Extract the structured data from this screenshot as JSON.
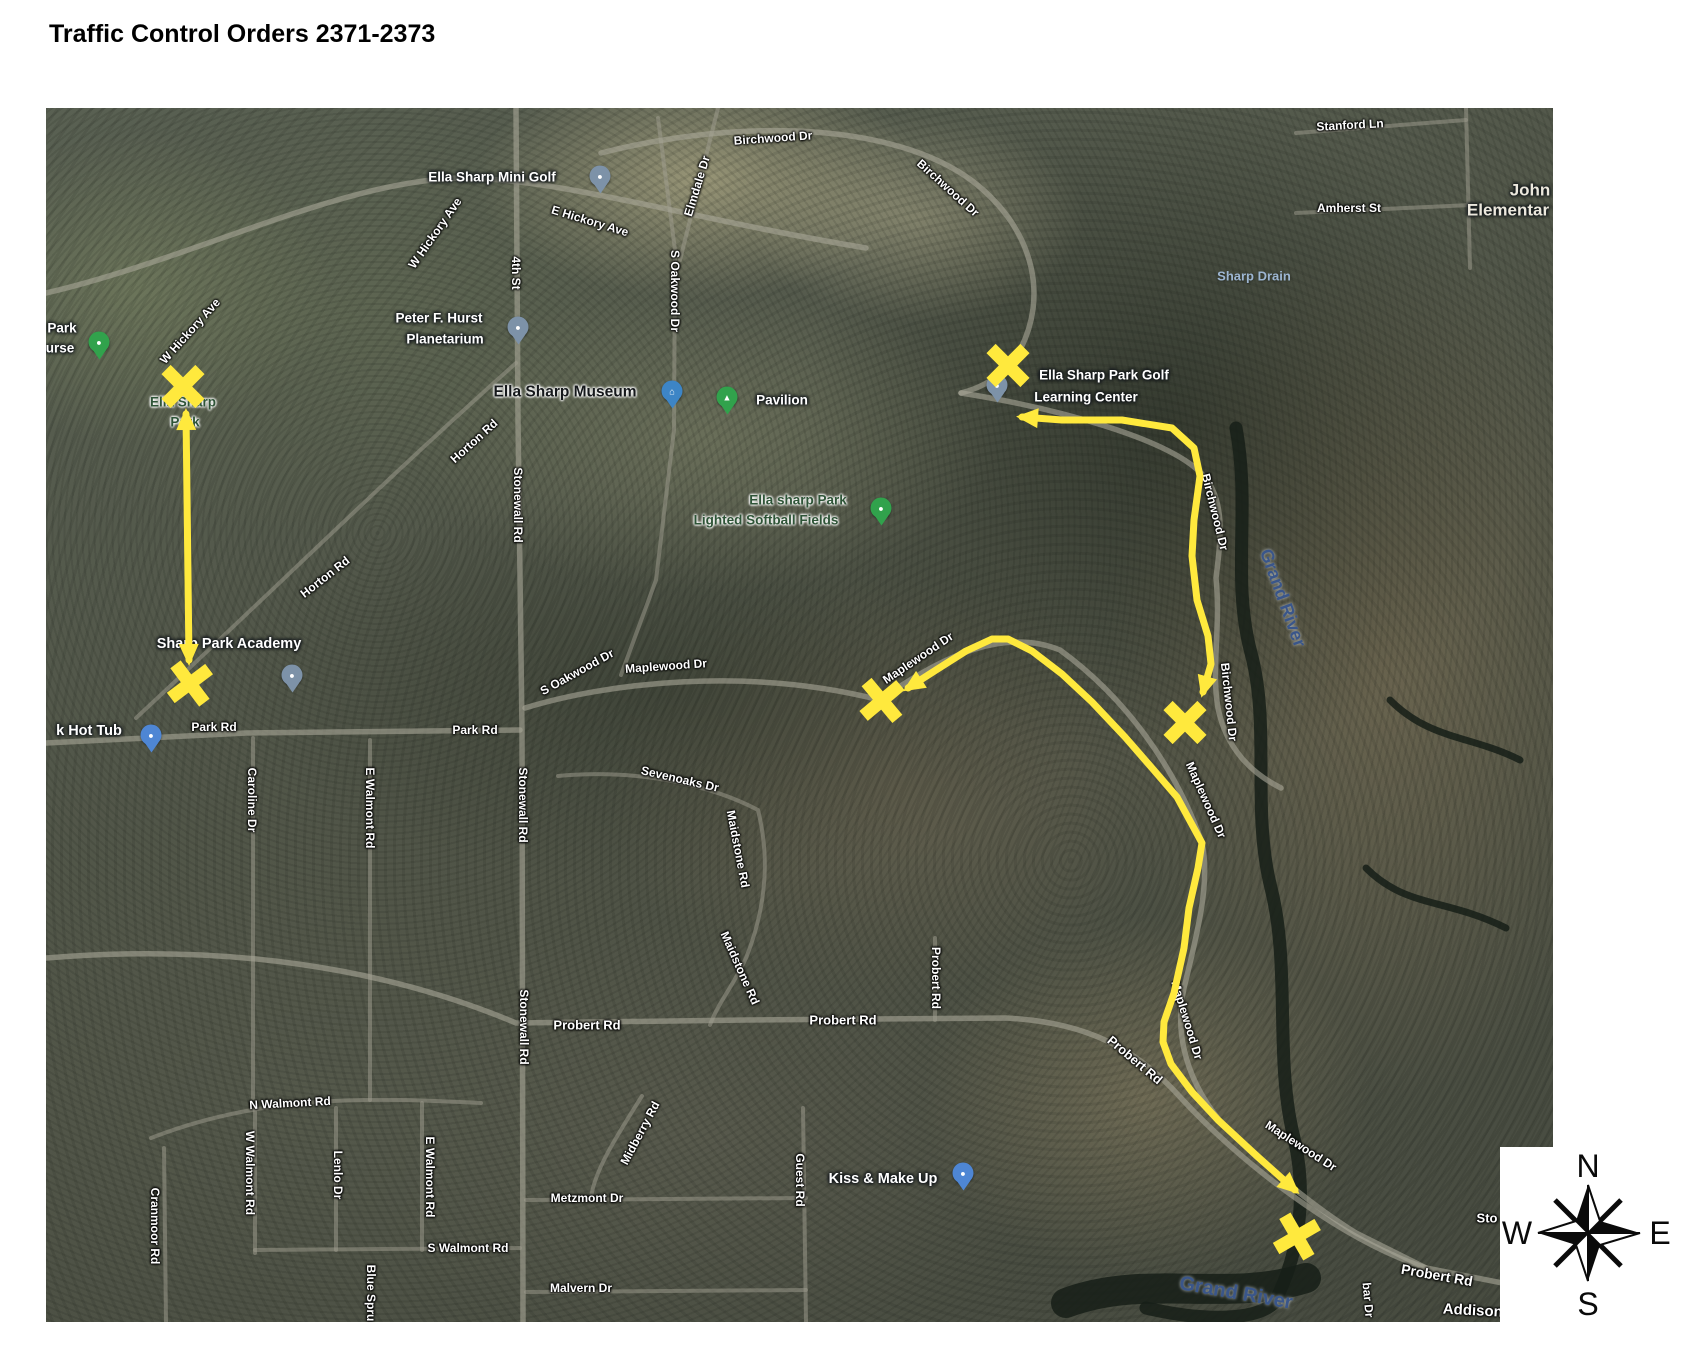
{
  "page": {
    "title": "Traffic Control Orders 2371-2373"
  },
  "map": {
    "colors": {
      "highlight": "#ffe93d",
      "pin_slate": "#7d92a8",
      "pin_blue": "#4e86d4",
      "pin_green": "#31a24c"
    },
    "labels": [
      {
        "name": "birchwood-dr-1",
        "text": "Birchwood Dr",
        "x": 773,
        "y": 138,
        "rot": -4,
        "cls": "road"
      },
      {
        "name": "birchwood-dr-2",
        "text": "Birchwood Dr",
        "x": 948,
        "y": 188,
        "rot": 42,
        "cls": "road"
      },
      {
        "name": "birchwood-dr-3",
        "text": "Birchwood Dr",
        "x": 1215,
        "y": 512,
        "rot": 76,
        "cls": "road"
      },
      {
        "name": "birchwood-dr-4",
        "text": "Birchwood Dr",
        "x": 1229,
        "y": 702,
        "rot": 84,
        "cls": "road"
      },
      {
        "name": "elmdale-dr",
        "text": "Elmdale Dr",
        "x": 697,
        "y": 186,
        "rot": -73,
        "cls": "road"
      },
      {
        "name": "e-hickory-ave",
        "text": "E Hickory Ave",
        "x": 590,
        "y": 221,
        "rot": 17,
        "cls": "road"
      },
      {
        "name": "w-hickory-ave-1",
        "text": "W Hickory Ave",
        "x": 435,
        "y": 233,
        "rot": -55,
        "cls": "road"
      },
      {
        "name": "w-hickory-ave-2",
        "text": "W Hickory Ave",
        "x": 190,
        "y": 331,
        "rot": -48,
        "cls": "road"
      },
      {
        "name": "fourth-st",
        "text": "4th St",
        "x": 516,
        "y": 273,
        "rot": 90,
        "cls": "road"
      },
      {
        "name": "s-oakwood-dr-1",
        "text": "S Oakwood Dr",
        "x": 675,
        "y": 291,
        "rot": 90,
        "cls": "road"
      },
      {
        "name": "stonewall-rd-1",
        "text": "Stonewall Rd",
        "x": 518,
        "y": 505,
        "rot": 90,
        "cls": "road"
      },
      {
        "name": "horton-rd-1",
        "text": "Horton Rd",
        "x": 474,
        "y": 441,
        "rot": -42,
        "cls": "road"
      },
      {
        "name": "horton-rd-2",
        "text": "Horton Rd",
        "x": 325,
        "y": 577,
        "rot": -38,
        "cls": "road"
      },
      {
        "name": "s-oakwood-dr-2",
        "text": "S Oakwood Dr",
        "x": 577,
        "y": 672,
        "rot": -29,
        "cls": "road"
      },
      {
        "name": "maplewood-dr-1",
        "text": "Maplewood Dr",
        "x": 666,
        "y": 666,
        "rot": -4,
        "cls": "road"
      },
      {
        "name": "maplewood-dr-2",
        "text": "Maplewood Dr",
        "x": 918,
        "y": 658,
        "rot": -34,
        "cls": "road"
      },
      {
        "name": "maplewood-dr-3",
        "text": "Maplewood Dr",
        "x": 1206,
        "y": 800,
        "rot": 66,
        "cls": "road"
      },
      {
        "name": "maplewood-dr-4",
        "text": "Maplewood Dr",
        "x": 1187,
        "y": 1020,
        "rot": 73,
        "cls": "road"
      },
      {
        "name": "maplewood-dr-5",
        "text": "Maplewood Dr",
        "x": 1301,
        "y": 1146,
        "rot": 33,
        "cls": "road"
      },
      {
        "name": "park-rd-1",
        "text": "Park Rd",
        "x": 214,
        "y": 727,
        "rot": 0,
        "cls": "road"
      },
      {
        "name": "park-rd-2",
        "text": "Park Rd",
        "x": 475,
        "y": 730,
        "rot": 0,
        "cls": "road"
      },
      {
        "name": "caroline-dr",
        "text": "Caroline Dr",
        "x": 252,
        "y": 800,
        "rot": 90,
        "cls": "road"
      },
      {
        "name": "e-walmont-rd-1",
        "text": "E Walmont Rd",
        "x": 370,
        "y": 808,
        "rot": 90,
        "cls": "road"
      },
      {
        "name": "stonewall-rd-2",
        "text": "Stonewall Rd",
        "x": 523,
        "y": 805,
        "rot": 90,
        "cls": "road"
      },
      {
        "name": "sevenoaks-dr",
        "text": "Sevenoaks Dr",
        "x": 680,
        "y": 779,
        "rot": 13,
        "cls": "road"
      },
      {
        "name": "maidstone-rd-1",
        "text": "Maidstone Rd",
        "x": 738,
        "y": 849,
        "rot": 79,
        "cls": "road"
      },
      {
        "name": "maidstone-rd-2",
        "text": "Maidstone Rd",
        "x": 740,
        "y": 968,
        "rot": 66,
        "cls": "road"
      },
      {
        "name": "stonewall-rd-3",
        "text": "Stonewall Rd",
        "x": 524,
        "y": 1027,
        "rot": 90,
        "cls": "road"
      },
      {
        "name": "probert-rd-1",
        "text": "Probert Rd",
        "x": 587,
        "y": 1025,
        "rot": 0,
        "cls": "road",
        "size": 13
      },
      {
        "name": "probert-rd-2",
        "text": "Probert Rd",
        "x": 843,
        "y": 1020,
        "rot": 0,
        "cls": "road",
        "size": 13
      },
      {
        "name": "probert-rd-3",
        "text": "Probert Rd",
        "x": 936,
        "y": 978,
        "rot": 90,
        "cls": "road"
      },
      {
        "name": "probert-rd-4",
        "text": "Probert Rd",
        "x": 1135,
        "y": 1060,
        "rot": 40,
        "cls": "road",
        "size": 13
      },
      {
        "name": "probert-rd-5",
        "text": "Probert Rd",
        "x": 1437,
        "y": 1275,
        "rot": 10,
        "cls": "road",
        "size": 14
      },
      {
        "name": "n-walmont-rd",
        "text": "N Walmont Rd",
        "x": 290,
        "y": 1103,
        "rot": -3,
        "cls": "road"
      },
      {
        "name": "w-walmont-rd",
        "text": "W Walmont Rd",
        "x": 250,
        "y": 1173,
        "rot": 90,
        "cls": "road"
      },
      {
        "name": "lenlo-dr",
        "text": "Lenlo Dr",
        "x": 338,
        "y": 1175,
        "rot": 90,
        "cls": "road"
      },
      {
        "name": "e-walmont-rd-2",
        "text": "E Walmont Rd",
        "x": 430,
        "y": 1177,
        "rot": 90,
        "cls": "road"
      },
      {
        "name": "s-walmont-rd",
        "text": "S Walmont Rd",
        "x": 468,
        "y": 1248,
        "rot": 0,
        "cls": "road"
      },
      {
        "name": "cranmoor-rd",
        "text": "Cranmoor Rd",
        "x": 155,
        "y": 1226,
        "rot": 90,
        "cls": "road"
      },
      {
        "name": "blue-spruce",
        "text": "Blue Spru",
        "x": 371,
        "y": 1293,
        "rot": 90,
        "cls": "road"
      },
      {
        "name": "midberry-rd",
        "text": "Midberry Rd",
        "x": 640,
        "y": 1133,
        "rot": -62,
        "cls": "road"
      },
      {
        "name": "guest-rd",
        "text": "Guest Rd",
        "x": 800,
        "y": 1180,
        "rot": 90,
        "cls": "road"
      },
      {
        "name": "metzmont-dr",
        "text": "Metzmont Dr",
        "x": 587,
        "y": 1198,
        "rot": 0,
        "cls": "road"
      },
      {
        "name": "malvern-dr",
        "text": "Malvern Dr",
        "x": 581,
        "y": 1288,
        "rot": 0,
        "cls": "road"
      },
      {
        "name": "stanford-ln",
        "text": "Stanford Ln",
        "x": 1350,
        "y": 125,
        "rot": -3,
        "cls": "road"
      },
      {
        "name": "amherst-st",
        "text": "Amherst St",
        "x": 1349,
        "y": 208,
        "rot": 0,
        "cls": "road"
      },
      {
        "name": "addison-ave",
        "text": "Addison A",
        "x": 1480,
        "y": 1311,
        "rot": 3,
        "cls": "road",
        "size": 15
      },
      {
        "name": "bar-dr",
        "text": "bar Dr",
        "x": 1368,
        "y": 1300,
        "rot": 85,
        "cls": "road"
      },
      {
        "name": "sto-partial",
        "text": "Sto",
        "x": 1487,
        "y": 1218,
        "rot": 0,
        "cls": "road",
        "size": 13
      },
      {
        "name": "mini-golf",
        "text": "Ella Sharp Mini Golf",
        "x": 492,
        "y": 177,
        "rot": 0,
        "cls": "poi"
      },
      {
        "name": "planetarium-line1",
        "text": "Peter F. Hurst",
        "x": 439,
        "y": 318,
        "rot": 0,
        "cls": "poi"
      },
      {
        "name": "planetarium-line2",
        "text": "Planetarium",
        "x": 445,
        "y": 339,
        "rot": 0,
        "cls": "poi"
      },
      {
        "name": "museum",
        "text": "Ella Sharp Museum",
        "x": 565,
        "y": 392,
        "rot": 0,
        "cls": "poi-bold"
      },
      {
        "name": "pavilion",
        "text": "Pavilion",
        "x": 782,
        "y": 400,
        "rot": 0,
        "cls": "poi"
      },
      {
        "name": "learning-line1",
        "text": "Ella Sharp Park Golf",
        "x": 1104,
        "y": 375,
        "rot": 0,
        "cls": "poi"
      },
      {
        "name": "learning-line2",
        "text": "Learning Center",
        "x": 1086,
        "y": 397,
        "rot": 0,
        "cls": "poi"
      },
      {
        "name": "academy",
        "text": "Sharp Park Academy",
        "x": 229,
        "y": 644,
        "rot": 0,
        "cls": "poi",
        "size": 14.5
      },
      {
        "name": "hot-tub",
        "text": "k Hot Tub",
        "x": 89,
        "y": 731,
        "rot": 0,
        "cls": "poi",
        "size": 14.5
      },
      {
        "name": "kiss-make-up",
        "text": "Kiss & Make Up",
        "x": 883,
        "y": 1179,
        "rot": 0,
        "cls": "poi",
        "size": 14.5
      },
      {
        "name": "john-elementary-line1",
        "text": "John",
        "x": 1530,
        "y": 190,
        "rot": 0,
        "cls": "school"
      },
      {
        "name": "john-elementary-line2",
        "text": "Elementar",
        "x": 1508,
        "y": 210,
        "rot": 0,
        "cls": "school"
      },
      {
        "name": "golf-course-partial-1",
        "text": "Park",
        "x": 62,
        "y": 328,
        "rot": 0,
        "cls": "poi"
      },
      {
        "name": "golf-course-partial-2",
        "text": "urse",
        "x": 60,
        "y": 348,
        "rot": 0,
        "cls": "poi"
      },
      {
        "name": "ella-sharp-park-line1",
        "text": "Ella Sharp",
        "x": 183,
        "y": 402,
        "rot": 0,
        "cls": "park"
      },
      {
        "name": "ella-sharp-park-line2",
        "text": "Park",
        "x": 185,
        "y": 422,
        "rot": 0,
        "cls": "park"
      },
      {
        "name": "softball-line1",
        "text": "Ella sharp Park",
        "x": 798,
        "y": 500,
        "rot": 0,
        "cls": "park"
      },
      {
        "name": "softball-line2",
        "text": "Lighted Softball Fields",
        "x": 766,
        "y": 520,
        "rot": 0,
        "cls": "park"
      },
      {
        "name": "sharp-drain",
        "text": "Sharp Drain",
        "x": 1254,
        "y": 276,
        "rot": 0,
        "cls": "water"
      },
      {
        "name": "grand-river-1",
        "text": "Grand River",
        "x": 1283,
        "y": 598,
        "rot": 70,
        "cls": "water-big"
      },
      {
        "name": "grand-river-2",
        "text": "Grand River",
        "x": 1236,
        "y": 1293,
        "rot": 10,
        "cls": "water-big",
        "size": 20
      }
    ],
    "pins": [
      {
        "name": "mini-golf-pin",
        "x": 600,
        "y": 176,
        "color": "slate",
        "glyph": "●"
      },
      {
        "name": "planetarium-pin",
        "x": 518,
        "y": 327,
        "color": "slate",
        "glyph": "●"
      },
      {
        "name": "museum-pin",
        "x": 672,
        "y": 391,
        "color": "mblue",
        "glyph": "⌂"
      },
      {
        "name": "pavilion-pin",
        "x": 727,
        "y": 397,
        "color": "green",
        "glyph": "▲"
      },
      {
        "name": "softball-fields-pin",
        "x": 881,
        "y": 508,
        "color": "green",
        "glyph": "●"
      },
      {
        "name": "golf-learning-pin",
        "x": 997,
        "y": 385,
        "color": "slate",
        "glyph": "●"
      },
      {
        "name": "golf-course-pin",
        "x": 99,
        "y": 342,
        "color": "green",
        "glyph": "●"
      },
      {
        "name": "academy-pin",
        "x": 292,
        "y": 675,
        "color": "slate",
        "glyph": "●"
      },
      {
        "name": "hot-tub-pin",
        "x": 151,
        "y": 735,
        "color": "blue",
        "glyph": "●"
      },
      {
        "name": "kiss-make-up-pin",
        "x": 963,
        "y": 1173,
        "color": "blue",
        "glyph": "●"
      }
    ],
    "x_marks": [
      {
        "x": 183,
        "y": 386,
        "rot": 0
      },
      {
        "x": 190,
        "y": 683,
        "rot": 8
      },
      {
        "x": 1008,
        "y": 365,
        "rot": 0
      },
      {
        "x": 882,
        "y": 700,
        "rot": 5
      },
      {
        "x": 1185,
        "y": 722,
        "rot": 0
      },
      {
        "x": 1297,
        "y": 1236,
        "rot": 15
      }
    ],
    "arrows": [
      {
        "name": "route-hickory-to-park-rd",
        "points": [
          [
            186,
            414
          ],
          [
            189,
            660
          ]
        ]
      },
      {
        "name": "route-birchwood",
        "points": [
          [
            1022,
            417
          ],
          [
            1062,
            420
          ],
          [
            1122,
            420
          ],
          [
            1172,
            428
          ],
          [
            1194,
            448
          ],
          [
            1200,
            476
          ],
          [
            1194,
            520
          ],
          [
            1192,
            556
          ],
          [
            1197,
            600
          ],
          [
            1208,
            636
          ],
          [
            1211,
            664
          ],
          [
            1203,
            692
          ]
        ]
      },
      {
        "name": "route-maplewood",
        "points": [
          [
            908,
            688
          ],
          [
            936,
            670
          ],
          [
            966,
            651
          ],
          [
            992,
            639
          ],
          [
            1008,
            639
          ],
          [
            1032,
            651
          ],
          [
            1062,
            674
          ],
          [
            1092,
            702
          ],
          [
            1125,
            737
          ],
          [
            1152,
            768
          ],
          [
            1177,
            797
          ],
          [
            1202,
            843
          ],
          [
            1198,
            868
          ],
          [
            1189,
            908
          ],
          [
            1184,
            948
          ],
          [
            1174,
            993
          ],
          [
            1164,
            1022
          ],
          [
            1163,
            1042
          ],
          [
            1171,
            1064
          ],
          [
            1192,
            1092
          ],
          [
            1218,
            1120
          ],
          [
            1258,
            1157
          ],
          [
            1295,
            1190
          ]
        ]
      }
    ],
    "compass": {
      "n": "N",
      "e": "E",
      "s": "S",
      "w": "W"
    }
  }
}
